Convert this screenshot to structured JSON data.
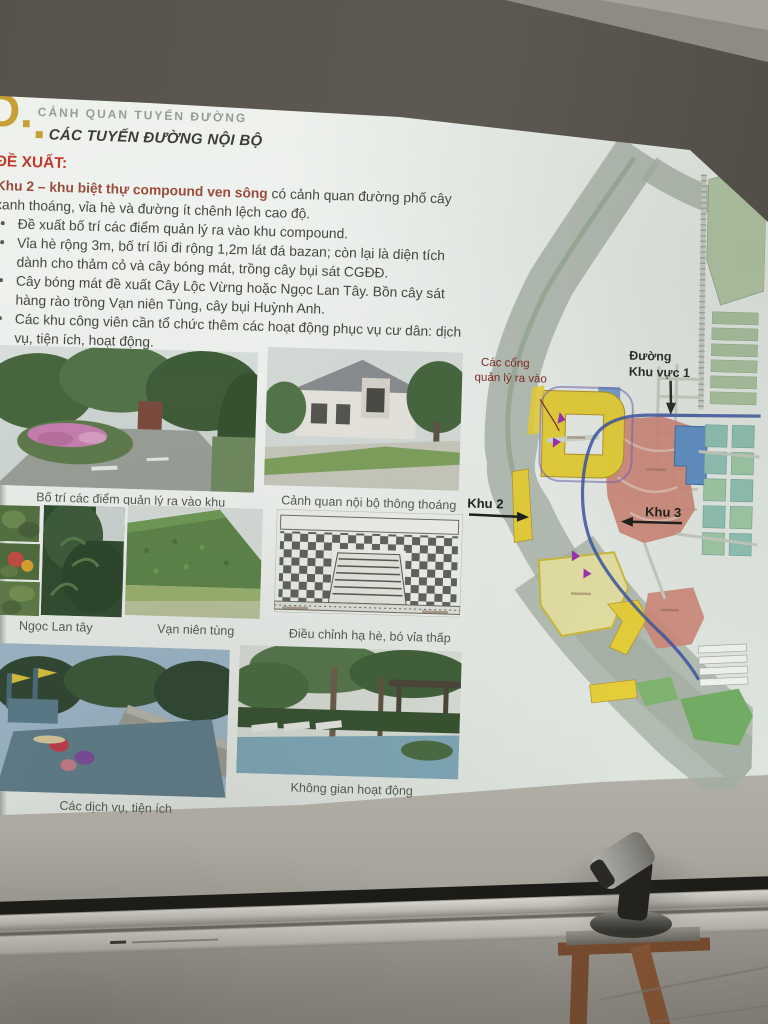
{
  "header": {
    "section_letter": "D.",
    "kicker": "CẢNH QUAN TUYẾN ĐƯỜNG",
    "title": "CÁC TUYẾN ĐƯỜNG NỘI BỘ"
  },
  "proposal": {
    "heading": "ĐỀ XUẤT:",
    "intro_bold": "Khu 2 – khu biệt thự compound ven sông",
    "intro_rest": " có cảnh quan đường phố cây xanh thoáng, vỉa hè và đường ít chênh lệch cao độ.",
    "bullets": [
      "Đề xuất bố trí các điểm quản lý ra vào khu compound.",
      "Vỉa hè rộng 3m, bố trí lối đi rộng 1,2m lát đá bazan; còn lại là diện tích dành cho thảm cỏ và cây bóng mát, trồng cây bụi sát CGĐĐ.",
      "Cây bóng mát đề xuất Cây Lộc Vừng hoặc Ngọc Lan Tây. Bồn cây sát hàng rào trồng Vạn niên Tùng, cây bụi Huỳnh Anh.",
      "Các khu công viên cần tổ chức thêm các hoạt động phục vụ cư dân: dịch vụ, tiện ích, hoạt động."
    ]
  },
  "figures": {
    "row1_left_caption": "Bố trí các điểm quản lý ra vào khu",
    "row1_right_caption": "Cảnh quan nội bộ thông thoáng",
    "row2_left_caption": "Ngọc Lan tây",
    "row2_mid_caption": "Vạn niên tùng",
    "row2_right_caption": "Điều chỉnh hạ hè, bó vỉa thấp",
    "row3_left_caption": "Các dịch vụ, tiện ích",
    "row3_right_caption": "Không gian hoạt động"
  },
  "map": {
    "labels": {
      "gates_line1": "Các cổng",
      "gates_line2": "quản lý ra vào",
      "road_line1": "Đường",
      "road_line2": "Khu vực 1",
      "zone2": "Khu 2",
      "zone3": "Khu 3"
    }
  },
  "colors": {
    "accent_gold": "#C6A035",
    "heading_red": "#C13A2B",
    "intro_maroon": "#9A4C3C",
    "map_yellow": "#E5CE39",
    "map_red": "#CC8577",
    "map_blue": "#5F8FC2",
    "map_teal": "#8FC0B2",
    "map_green": "#72AC64",
    "map_river": "#A6B0A5",
    "map_road_blue": "#3B54A0",
    "map_gate_purple": "#9C2FB4"
  }
}
